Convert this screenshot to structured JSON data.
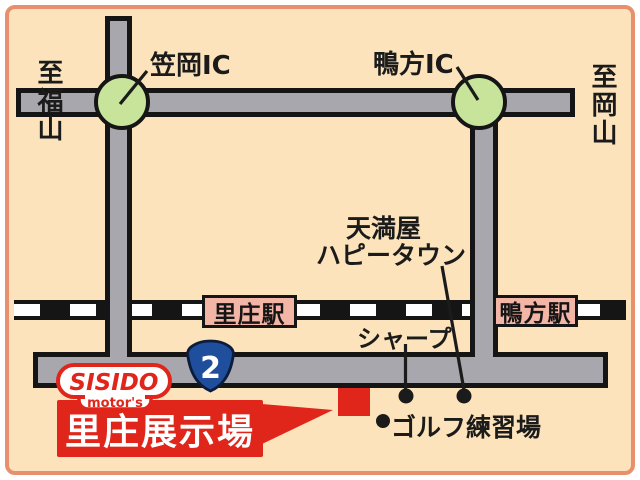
{
  "map": {
    "interchanges": {
      "kasaoka": {
        "label": "笠岡IC"
      },
      "kamogata": {
        "label": "鴨方IC"
      }
    },
    "directions": {
      "left": "至福山",
      "right": "至岡山"
    },
    "stations": {
      "satosho": "里庄駅",
      "kamogata": "鴨方駅"
    },
    "landmarks": {
      "tenmaya_line1": "天満屋",
      "tenmaya_line2": "ハピータウン",
      "sharp": "シャープ",
      "golf": "ゴルフ練習場"
    },
    "route_shield": {
      "number": "2"
    },
    "dealer": {
      "brand": "SISIDO",
      "brand_sub": "motor's",
      "showroom": "里庄展示場"
    },
    "colors": {
      "background": "#fce3bb",
      "panel_border": "#e8906e",
      "road_gray": "#a7a7ad",
      "line_black": "#151515",
      "ic_green": "#c8e49b",
      "station_pink": "#f2b5a6",
      "brand_red": "#e0251b",
      "route_blue": "#1e4e9c"
    }
  }
}
